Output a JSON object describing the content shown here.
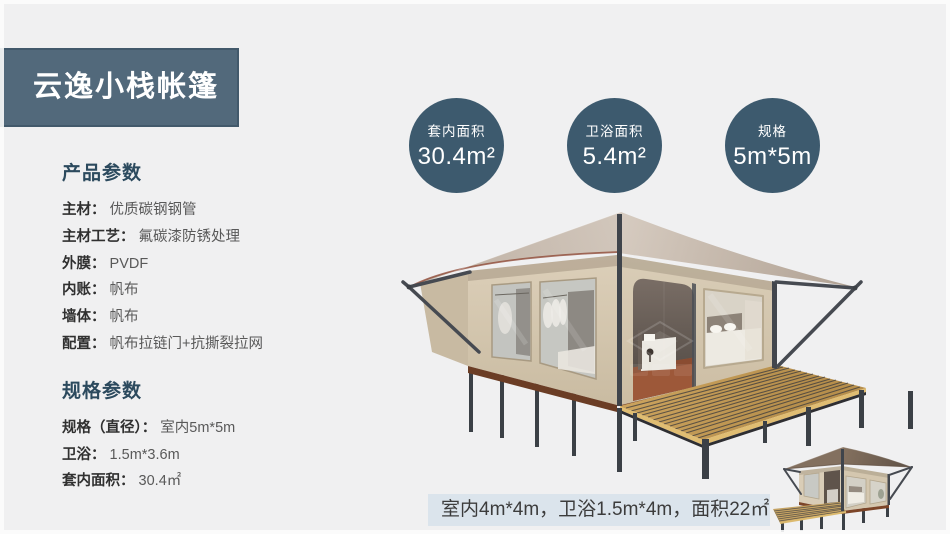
{
  "slide": {
    "background": "#f0f0f1",
    "frame_color": "#fcfcfc"
  },
  "title_banner": {
    "text": "云逸小栈帐篷",
    "bg": "#52697b",
    "border": "#42596b"
  },
  "product_params": {
    "heading": "产品参数",
    "rows": [
      {
        "label": "主材：",
        "value": "优质碳钢钢管"
      },
      {
        "label": "主材工艺：",
        "value": "氟碳漆防锈处理"
      },
      {
        "label": "外膜：",
        "value": "PVDF"
      },
      {
        "label": "内账：",
        "value": "帆布"
      },
      {
        "label": "墙体：",
        "value": "帆布"
      },
      {
        "label": "配置：",
        "value": "帆布拉链门+抗撕裂拉网"
      }
    ]
  },
  "spec_params": {
    "heading": "规格参数",
    "rows": [
      {
        "label": "规格（直径）：",
        "value": "室内5m*5m"
      },
      {
        "label": "卫浴：",
        "value": "1.5m*3.6m"
      },
      {
        "label": "套内面积：",
        "value": "30.4㎡"
      }
    ]
  },
  "stat_circles": [
    {
      "label": "套内面积",
      "value": "30.4m²"
    },
    {
      "label": "卫浴面积",
      "value": "5.4m²"
    },
    {
      "label": "规格",
      "value": "5m*5m"
    }
  ],
  "caption": {
    "text": "室内4m*4m，卫浴1.5m*4m，面积22㎡",
    "bg": "#dbe4ec"
  },
  "colors": {
    "circle_fill": "#3d5a6e",
    "heading": "#2c4a5e",
    "label_text": "#303030",
    "value_text": "#595959",
    "tent_wall": "#d6c9b2",
    "tent_roof": "#c6bab0",
    "deck_wood": "#c79f5f",
    "pole_metal": "#3f444b"
  }
}
